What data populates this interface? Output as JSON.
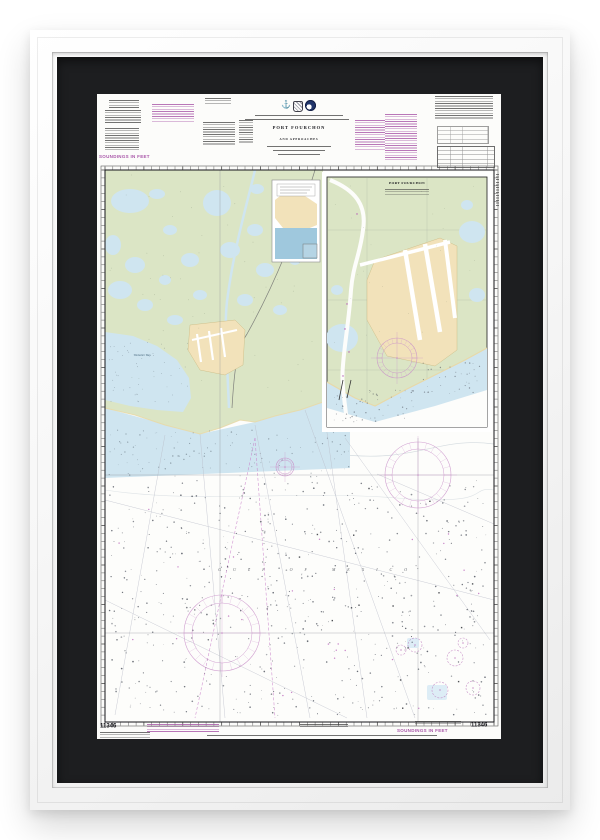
{
  "artwork_frame": {
    "frame_color": "#f5f5f5",
    "mat_color": "#1d1e20",
    "paper_color": "#fcfcfa"
  },
  "chart": {
    "title": "PORT FOURCHON",
    "subtitle": "AND APPROACHES",
    "number": "11346",
    "soundings_note": "SOUNDINGS IN FEET",
    "gulf_label": "GULF OF MEXICO",
    "inset_title": "PORT FOURCHON",
    "bay_label": "Timbalier Bay",
    "colors": {
      "note_magenta": "#a855a8",
      "marsh_green": "#dbe5c5",
      "shallow_water_blue": "#cfe5f0",
      "dredged_land_tan": "#f2e2ba",
      "compass_rose_magenta": "#c98fc9"
    }
  }
}
